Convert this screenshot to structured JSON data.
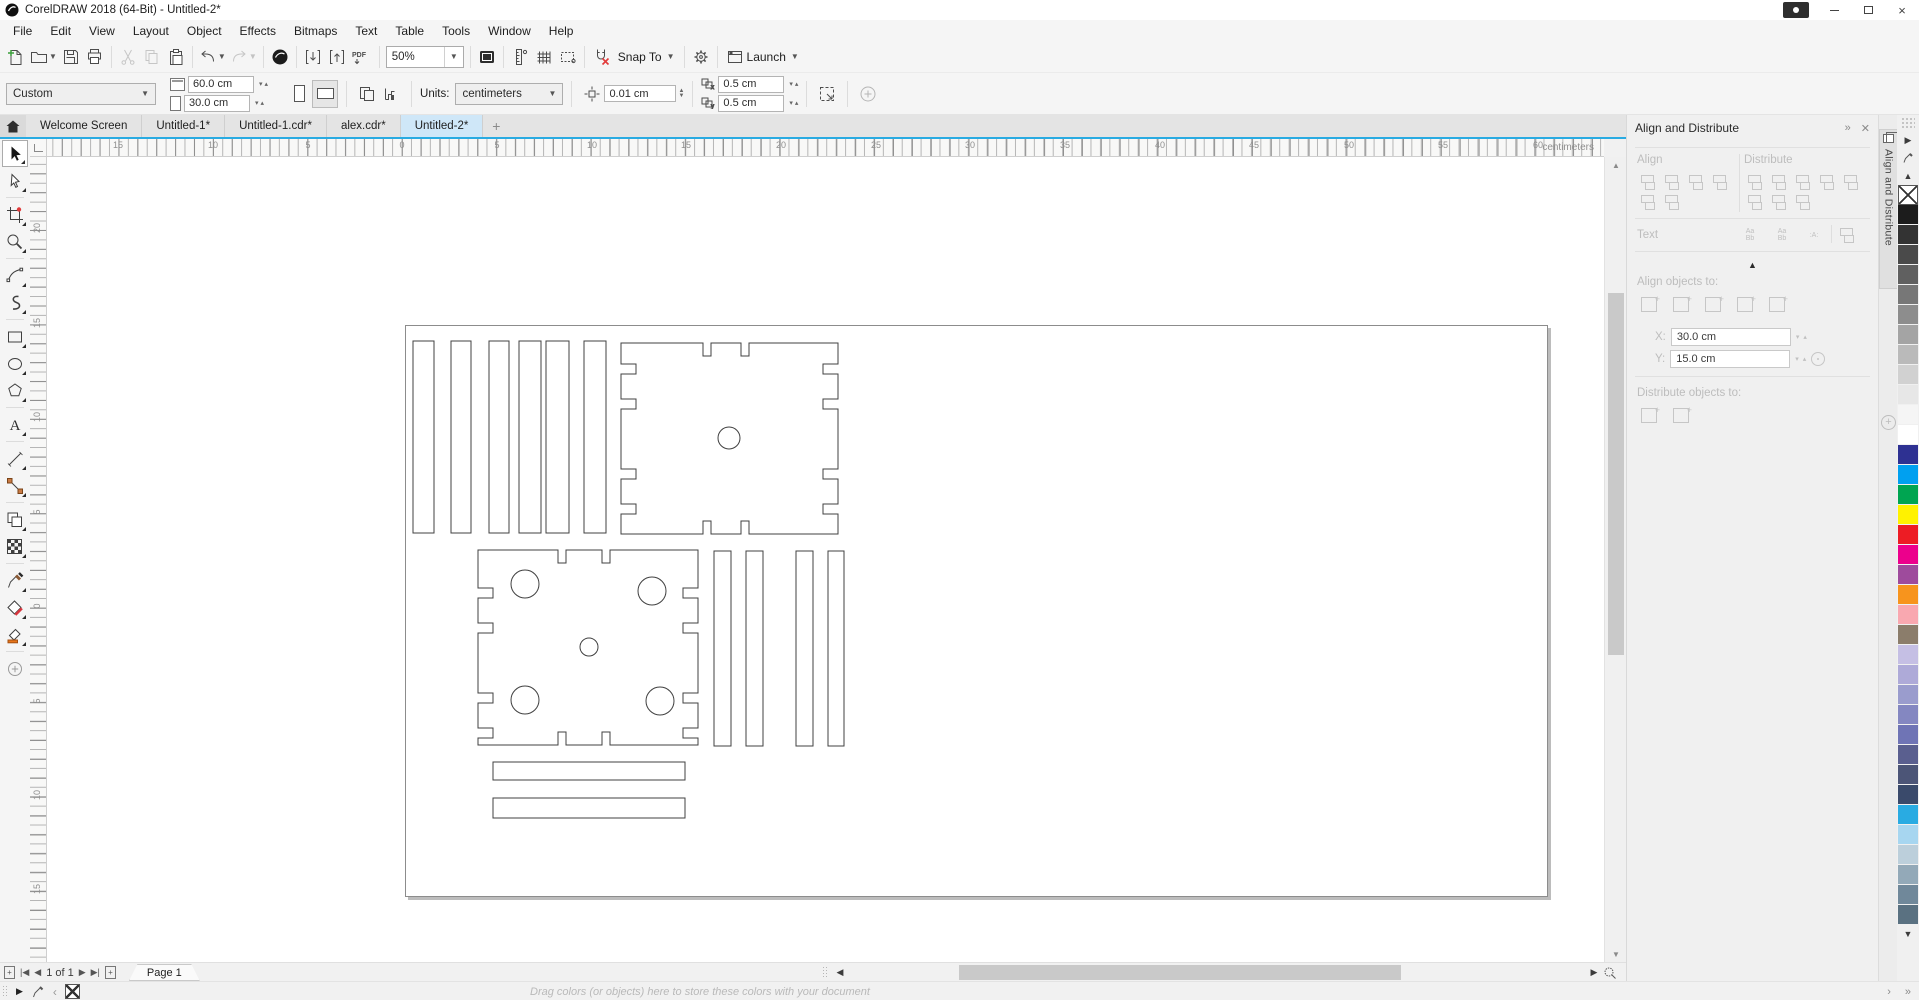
{
  "window": {
    "title": "CorelDRAW 2018 (64-Bit) - Untitled-2*"
  },
  "menu": {
    "items": [
      "File",
      "Edit",
      "View",
      "Layout",
      "Object",
      "Effects",
      "Bitmaps",
      "Text",
      "Table",
      "Tools",
      "Window",
      "Help"
    ]
  },
  "toolbar": {
    "zoom_level": "50%",
    "pdf_label": "PDF",
    "snap_to_label": "Snap To",
    "launch_label": "Launch",
    "icon_names": [
      "new-document",
      "open",
      "save",
      "print",
      "cut",
      "copy",
      "paste",
      "undo",
      "redo",
      "search-content",
      "import",
      "export",
      "publish-pdf",
      "zoom-levels",
      "fullscreen-preview",
      "show-rulers",
      "show-grid",
      "show-guidelines",
      "snap-off",
      "snap-to",
      "options",
      "launch"
    ]
  },
  "propbar": {
    "preset": "Custom",
    "page_width": "60.0 cm",
    "page_height": "30.0 cm",
    "units_label": "Units:",
    "units": "centimeters",
    "nudge": "0.01 cm",
    "dup_x": "0.5 cm",
    "dup_y": "0.5 cm"
  },
  "doc_tabs": {
    "tabs": [
      {
        "label": "Welcome Screen",
        "active": false
      },
      {
        "label": "Untitled-1*",
        "active": false
      },
      {
        "label": "Untitled-1.cdr*",
        "active": false
      },
      {
        "label": "alex.cdr*",
        "active": false
      },
      {
        "label": "Untitled-2*",
        "active": true
      }
    ],
    "new_tab": "+"
  },
  "ruler": {
    "unit": "centimeters",
    "h": [
      [
        "15",
        71
      ],
      [
        "10",
        166
      ],
      [
        "5",
        261
      ],
      [
        "0",
        355
      ],
      [
        "5",
        450
      ],
      [
        "10",
        545
      ],
      [
        "15",
        639
      ],
      [
        "20",
        734
      ],
      [
        "25",
        829
      ],
      [
        "30",
        923
      ],
      [
        "35",
        1018
      ],
      [
        "40",
        1113
      ],
      [
        "45",
        1207
      ],
      [
        "50",
        1302
      ],
      [
        "55",
        1396
      ],
      [
        "60",
        1491
      ]
    ],
    "v": [
      [
        "20",
        73
      ],
      [
        "15",
        168
      ],
      [
        "10",
        262
      ],
      [
        "5",
        357
      ],
      [
        "0",
        451
      ],
      [
        "5",
        546
      ],
      [
        "10",
        640
      ],
      [
        "15",
        734
      ]
    ]
  },
  "toolbox": {
    "tools": [
      "pick",
      "shape",
      "crop",
      "zoom",
      "freehand",
      "artistic-media",
      "rectangle",
      "ellipse",
      "polygon",
      "text",
      "straight-line",
      "connector",
      "drop-shadow",
      "mesh-fill",
      "color-eyedropper",
      "smart-fill",
      "interactive-fill",
      "more-tools"
    ]
  },
  "docker": {
    "title": "Align and Distribute",
    "tab_label": "Align and Distribute",
    "align_label": "Align",
    "distribute_label": "Distribute",
    "text_label": "Text",
    "align_to_label": "Align objects to:",
    "distribute_to_label": "Distribute objects to:",
    "x_label": "X:",
    "y_label": "Y:",
    "x_value": "30.0 cm",
    "y_value": "15.0 cm",
    "align_icons": [
      "align-left",
      "align-center-horizontal",
      "align-right",
      "align-top",
      "align-center-vertical",
      "align-bottom"
    ],
    "distribute_icons": [
      "distribute-left",
      "distribute-center-horizontal",
      "distribute-spacing-horizontal",
      "distribute-right",
      "distribute-top",
      "distribute-center-vertical",
      "distribute-spacing-vertical",
      "distribute-bottom"
    ],
    "text_icons": [
      {
        "name": "align-text-baseline",
        "glyph": "Aa\nBb"
      },
      {
        "name": "align-first-line-baseline",
        "glyph": "Aa\nBb"
      },
      {
        "name": "align-text-bounding-box",
        "glyph": ":A:"
      }
    ],
    "align_to_icons": [
      "active-objects",
      "page-edge",
      "page-center",
      "grid",
      "specified-point"
    ],
    "distribute_to_icons": [
      "extent-of-selection",
      "extent-of-page"
    ]
  },
  "palette": {
    "colors": [
      "#1c1c1c",
      "#333333",
      "#4a4a4a",
      "#606060",
      "#777777",
      "#8d8d8d",
      "#a4a4a4",
      "#bababa",
      "#d1d1d1",
      "#e7e7e7",
      "#f5f5f5",
      "#ffffff",
      "#2e3192",
      "#00a0f0",
      "#00a551",
      "#fff200",
      "#ed1c24",
      "#ec008c",
      "#9e4b9c",
      "#f7941d",
      "#f9a8b0",
      "#8b7d6b",
      "#c5bfe4",
      "#aeaad8",
      "#9a9ccd",
      "#8487c1",
      "#6f74b5",
      "#5a5f8f",
      "#4c5577",
      "#3a4a6b",
      "#29abe2",
      "#a7d6f0",
      "#bccfdb",
      "#93a9b8",
      "#70889a",
      "#5a7181"
    ]
  },
  "pagebar": {
    "page_info": "1 of 1",
    "page_tab": "Page 1"
  },
  "statusbar": {
    "hint": "Drag colors (or objects) here to store these colors with your document"
  },
  "canvas": {
    "stroke_color": "#404040",
    "shapes": [
      {
        "type": "rect",
        "x": 7,
        "y": 15,
        "w": 21,
        "h": 192
      },
      {
        "type": "rect",
        "x": 45,
        "y": 15,
        "w": 20,
        "h": 192
      },
      {
        "type": "rect",
        "x": 83,
        "y": 15,
        "w": 20,
        "h": 192
      },
      {
        "type": "rect",
        "x": 113,
        "y": 15,
        "w": 22,
        "h": 192
      },
      {
        "type": "rect",
        "x": 140,
        "y": 15,
        "w": 23,
        "h": 192
      },
      {
        "type": "rect",
        "x": 178,
        "y": 15,
        "w": 22,
        "h": 192
      },
      {
        "type": "path",
        "d": "M215,17 H297 V30 H305 V17 H335 V30 H343 V17 H432 V38 H417 V48 H432 V73 H417 V83 H432 V143 H417 V153 H432 V178 H417 V188 H432 V208 H343 V195 H335 V208 H305 V195 H297 V208 H215 V188 H230 V178 H215 V153 H230 V143 H215 V83 H230 V73 H215 V48 H230 V38 H215 Z"
      },
      {
        "type": "circle",
        "cx": 323,
        "cy": 112,
        "r": 11
      },
      {
        "type": "path",
        "d": "M72,224 H152 V237 H160 V224 H196 V237 H204 V224 H292 V262 H277 V272 H292 V297 H277 V307 H292 V367 H277 V377 H292 V402 H277 V412 H292 V419 H204 V406 H196 V419 H160 V406 H152 V419 H72 V412 H87 V402 H72 V377 H87 V367 H72 V307 H87 V297 H72 V272 H87 V262 H72 Z"
      },
      {
        "type": "circle",
        "cx": 119,
        "cy": 258,
        "r": 14
      },
      {
        "type": "circle",
        "cx": 246,
        "cy": 265,
        "r": 14
      },
      {
        "type": "circle",
        "cx": 183,
        "cy": 321,
        "r": 9
      },
      {
        "type": "circle",
        "cx": 119,
        "cy": 374,
        "r": 14
      },
      {
        "type": "circle",
        "cx": 254,
        "cy": 375,
        "r": 14
      },
      {
        "type": "rect",
        "x": 308,
        "y": 225,
        "w": 17,
        "h": 195
      },
      {
        "type": "rect",
        "x": 340,
        "y": 225,
        "w": 17,
        "h": 195
      },
      {
        "type": "rect",
        "x": 390,
        "y": 225,
        "w": 17,
        "h": 195
      },
      {
        "type": "rect",
        "x": 422,
        "y": 225,
        "w": 16,
        "h": 195
      },
      {
        "type": "rect",
        "x": 87,
        "y": 436,
        "w": 192,
        "h": 18
      },
      {
        "type": "rect",
        "x": 87,
        "y": 472,
        "w": 192,
        "h": 20
      }
    ]
  }
}
